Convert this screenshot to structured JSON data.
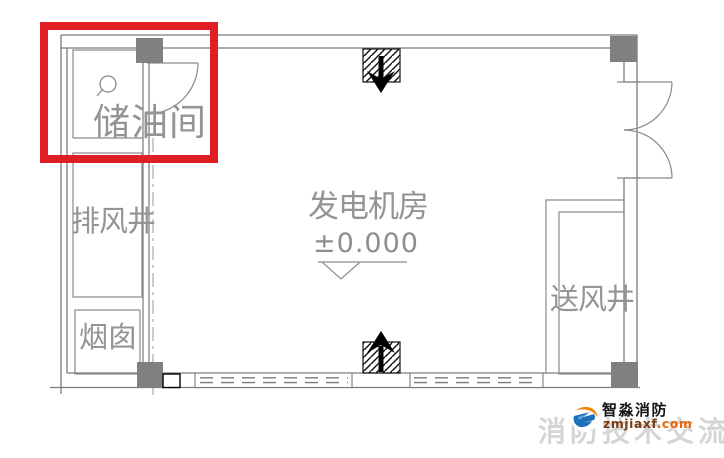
{
  "plan": {
    "rooms": {
      "oil_storage": "储油间",
      "exhaust_shaft": "排风井",
      "chimney": "烟囱",
      "generator_room": "发电机房",
      "generator_room_elevation": "±0.000",
      "supply_shaft": "送风井"
    },
    "symbols": {
      "top_vent": "hatched-air-inlet-down-arrow",
      "bottom_vent": "hatched-air-inlet-up-arrow",
      "elevation_marker": "inverted-open-triangle",
      "highlight": "red-box-around-oil-storage-room"
    }
  },
  "branding": {
    "name": "智淼消防",
    "url_main": "zmjiaxf",
    "url_suffix": ".com",
    "watermark": "消防技术交流"
  },
  "colors": {
    "highlight_red": "#e01e25",
    "wall_gray": "#7a7a7a",
    "column_gray": "#808080",
    "cad_text_gray": "#949494",
    "brand_orange": "#f08300",
    "brand_blue": "#1d6fb8"
  }
}
